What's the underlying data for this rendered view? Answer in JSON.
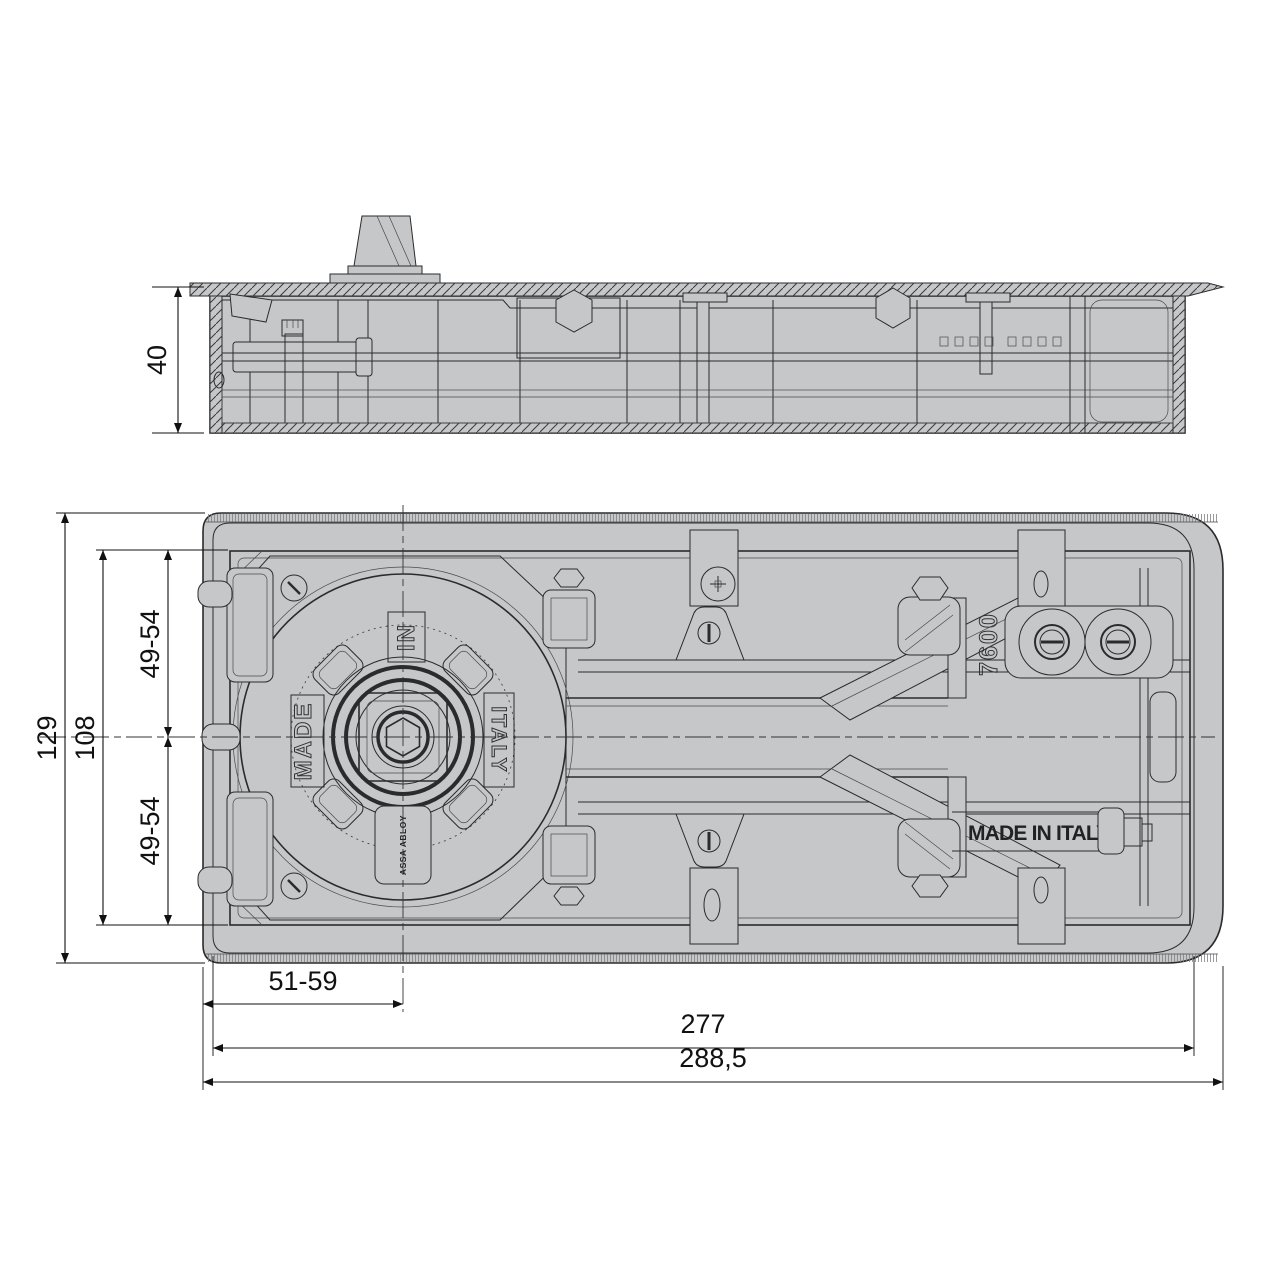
{
  "colors": {
    "background": "#ffffff",
    "metal_gray": "#c6c7c9",
    "line": "#2b2b2b",
    "dimension": "#111111"
  },
  "dimensions": {
    "side_height": "40",
    "cover_height": "129",
    "plate_height": "108",
    "axis_upper": "49-54",
    "axis_lower": "49-54",
    "spindle_offset": "51-59",
    "body_length": "277",
    "cover_length": "288,5"
  },
  "markings": {
    "made": "MADE",
    "in": "IN",
    "italy": "ITALY",
    "model": "7600",
    "made_in_italy": "MADE IN ITALY",
    "brand": "ASSA ABLOY"
  }
}
